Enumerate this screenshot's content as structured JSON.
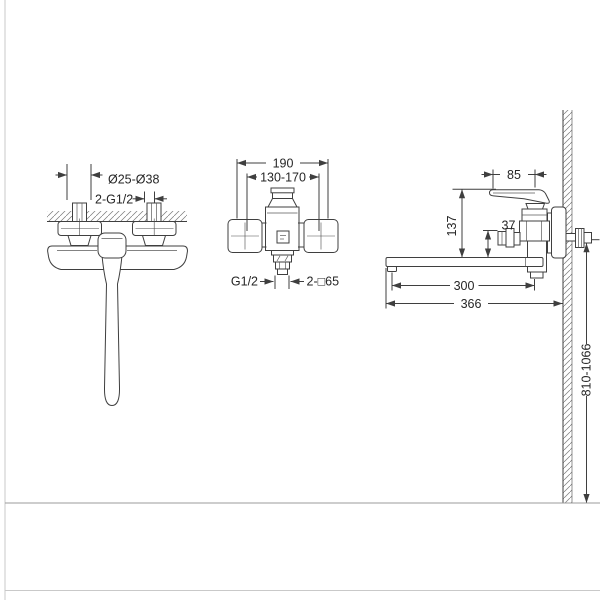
{
  "drawing": {
    "title_hint": "faucet installation dimension drawing",
    "background": "#ffffff",
    "stroke_color": "#3f3f3f",
    "hatch_color": "#7a7a7a",
    "border_color": "#c9c9c9",
    "floor_line_color": "#9b9b9b",
    "views": {
      "plan": {
        "labels": {
          "eccentric_diameter": "Ø25-Ø38",
          "inlet_connections": "2-G1/2"
        }
      },
      "front": {
        "labels": {
          "overall_width": "190",
          "center_distance": "130-170",
          "outlet_thread": "G1/2",
          "escutcheons": "2-□65"
        }
      },
      "side": {
        "labels": {
          "handle_projection": "85",
          "body_height": "137",
          "diverter_offset": "37",
          "spout_length": "300",
          "total_projection": "366",
          "mounting_height": "810-1066"
        }
      }
    }
  }
}
